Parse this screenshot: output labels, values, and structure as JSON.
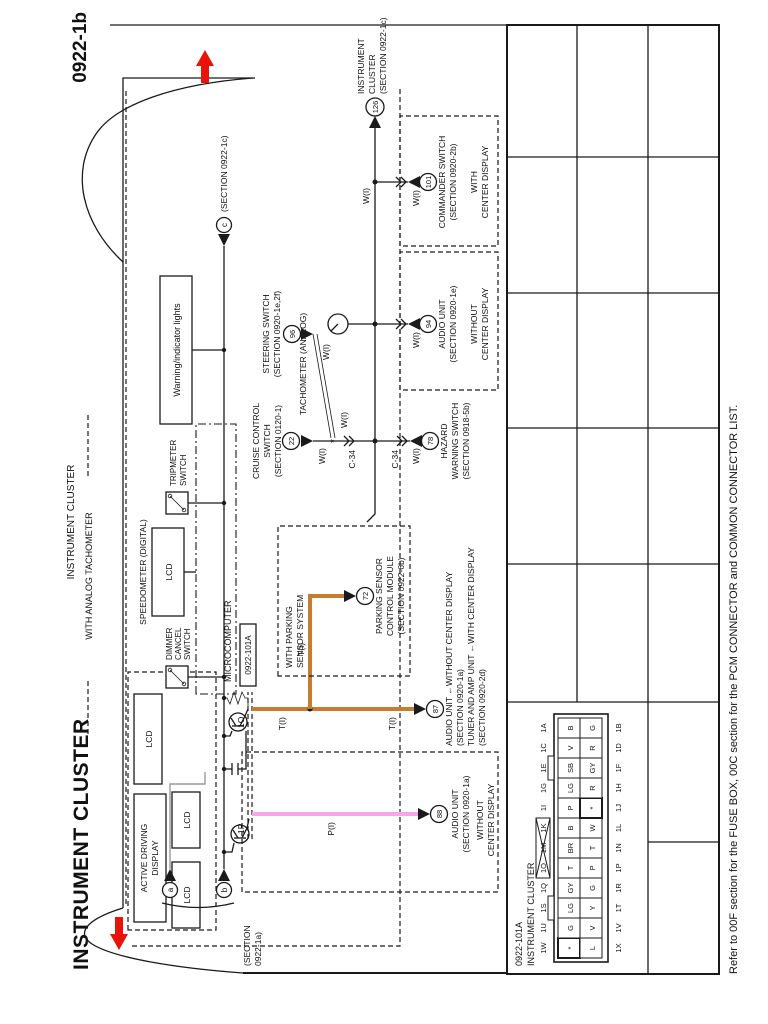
{
  "page": {
    "code": "0922-1b",
    "title": "INSTRUMENT CLUSTER",
    "footnote": "Refer to 00F section for the FUSE BOX, 00C section for the PCM CONNECTOR and COMMON CONNECTOR LIST."
  },
  "cluster": {
    "label": "INSTRUMENT CLUSTER",
    "variant": "WITH ANALOG TACHOMETER",
    "add": [
      "ACTIVE DRIVING",
      "DISPLAY"
    ],
    "lcd": "LCD",
    "speedometer": "SPEEDOMETER (DIGITAL)",
    "micro": "MICROCOMPUTER",
    "warning": "Warning/indicator lights",
    "tach": "TACHOMETER (ANALOG)",
    "trip": [
      "TRIPMETER",
      "SWITCH"
    ],
    "dimmer": [
      "DIMMER",
      "CANCEL",
      "SWITCH"
    ]
  },
  "connector": {
    "id": "0922-101A",
    "pin_1o": "1O",
    "pin_1p": "1P"
  },
  "wires": {
    "w_i": "W(I)",
    "t_i": "T(I)",
    "p_i": "P(I)",
    "c34": "C-34",
    "splice": "*"
  },
  "refs": {
    "source": {
      "letters": [
        "a",
        "b"
      ],
      "label_lines": [
        "(SECTION",
        "0922-1a)"
      ]
    },
    "c_out": {
      "letter": "c",
      "label": "(SECTION 0922-1c)"
    },
    "next": {
      "num": "126",
      "lines": [
        "INSTRUMENT",
        "CLUSTER",
        "(SECTION 0922-1c)"
      ]
    },
    "commander": {
      "num": "101",
      "lines": [
        "COMMANDER SWITCH",
        "(SECTION 0920-2b)"
      ],
      "box": [
        "WITH",
        "CENTER DISPLAY"
      ]
    },
    "audio_no_cd": {
      "num": "94",
      "lines": [
        "AUDIO UNIT",
        "(SECTION 0920-1e)"
      ],
      "box": [
        "WITHOUT",
        "CENTER DISPLAY"
      ]
    },
    "steering": {
      "num": "96",
      "lines": [
        "STEERING SWITCH",
        "(SECTION 0920-1e,2f)"
      ]
    },
    "cruise": {
      "num": "22",
      "lines": [
        "CRUISE CONTROL",
        "SWITCH",
        "(SECTION 0120-1)"
      ]
    },
    "hazard": {
      "num": "78",
      "lines": [
        "HAZARD",
        "WARNING SWITCH",
        "(SECTION 0918-5b)"
      ]
    },
    "parking": {
      "num": "72",
      "lines": [
        "PARKING SENSOR",
        "CONTROL MODULE",
        "(SECTION 0922-6b)"
      ],
      "box": [
        "WITH PARKING",
        "SENSOR SYSTEM"
      ]
    },
    "tuner": {
      "num": "87",
      "lines": [
        "AUDIO UNIT ←WITHOUT CENTER DISPLAY",
        "(SECTION 0920-1a)",
        "TUNER AND AMP UNIT ←WITH CENTER DISPLAY",
        "(SECTION 0920-2d)"
      ]
    },
    "audio_1a": {
      "num": "88",
      "lines": [
        "AUDIO UNIT",
        "(SECTION 0920-1a)"
      ],
      "box": [
        "WITHOUT",
        "CENTER DISPLAY"
      ]
    }
  },
  "pinout": {
    "header": [
      "0922-101A",
      "INSTRUMENT CLUSTER"
    ],
    "top": [
      "1W",
      "1U",
      "1S",
      "1Q",
      "1O",
      "1M",
      "1K",
      "1I",
      "1G",
      "1E",
      "1C",
      "1A"
    ],
    "bottom": [
      "1X",
      "1V",
      "1T",
      "1R",
      "1P",
      "1N",
      "1L",
      "1J",
      "1H",
      "1F",
      "1D",
      "1B"
    ],
    "row1": [
      "*",
      "G",
      "LG",
      "GY",
      "T",
      "BR",
      "B",
      "P",
      "LG",
      "SB",
      "V",
      "B"
    ],
    "row2": [
      "L",
      "V",
      "Y",
      "G",
      "P",
      "T",
      "W",
      "*",
      "R",
      "GY",
      "R",
      "G"
    ]
  }
}
